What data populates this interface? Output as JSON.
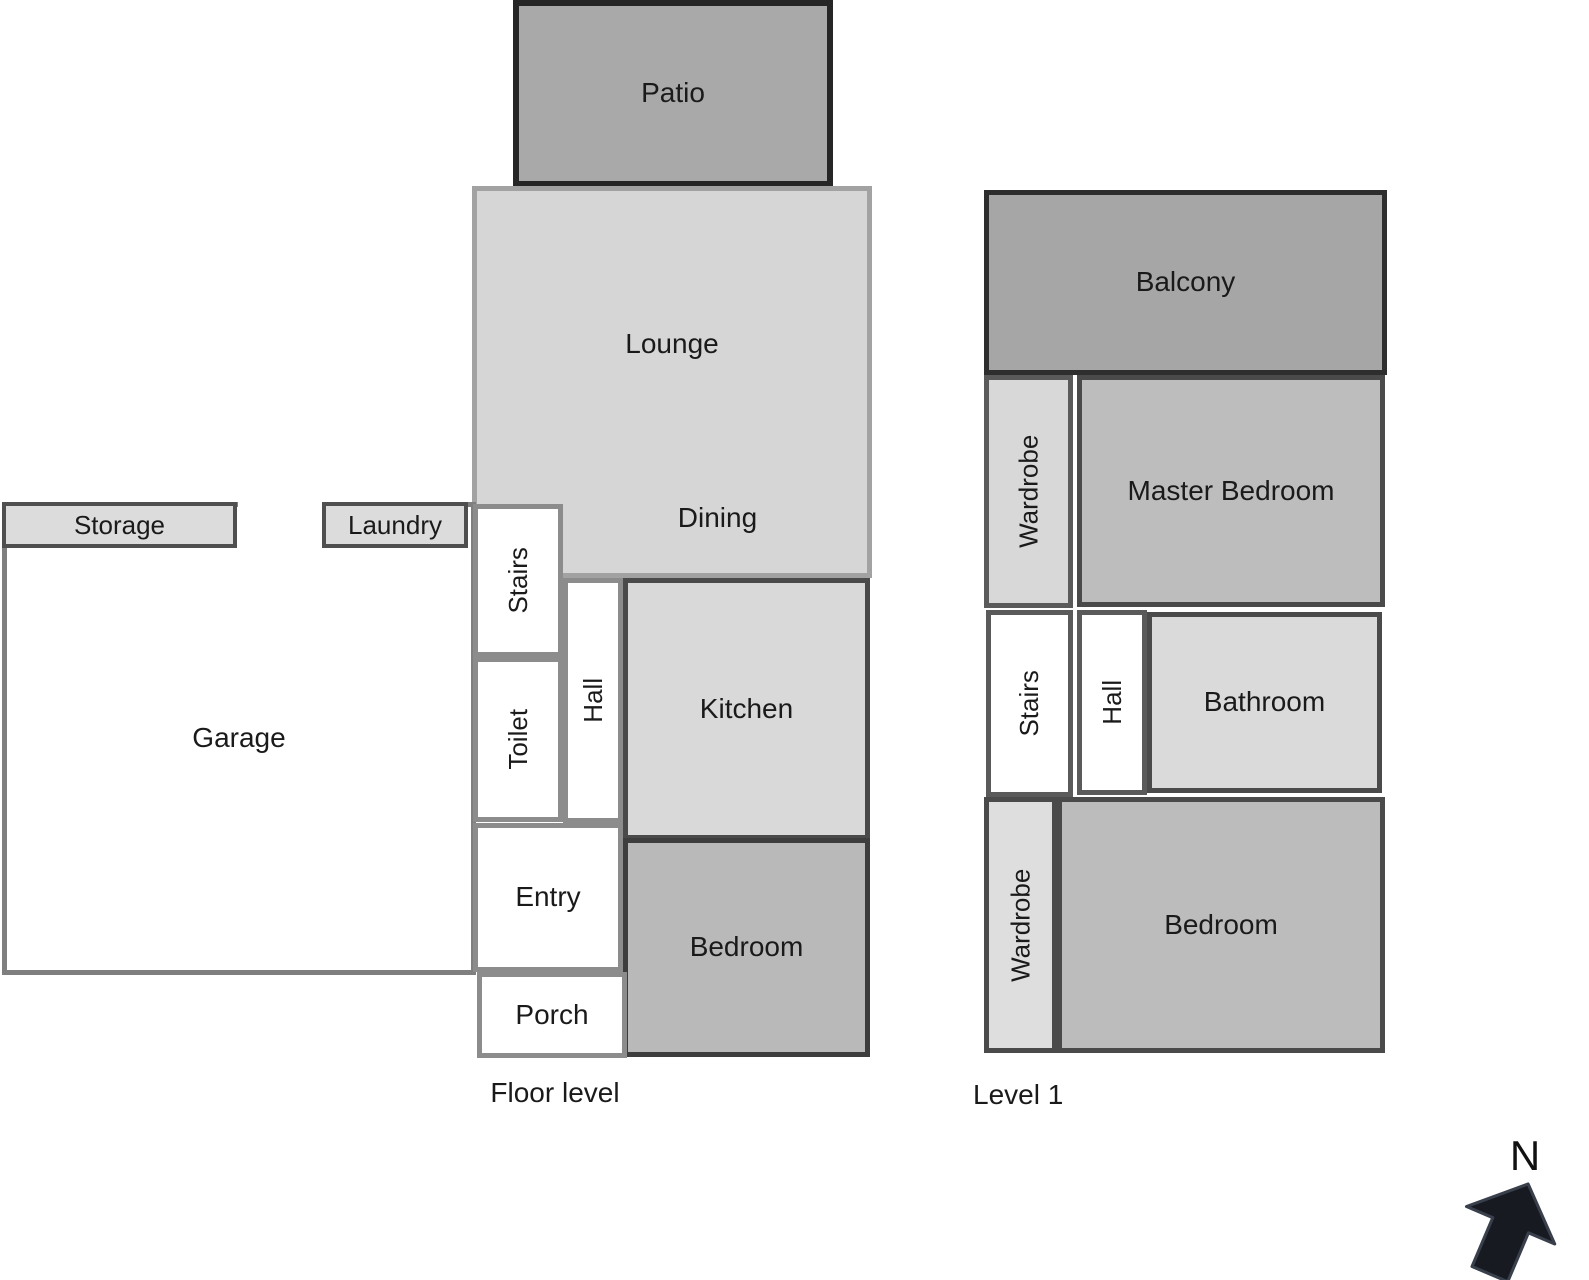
{
  "diagram": {
    "type": "floor-plan",
    "floor_level": {
      "caption": "Floor level",
      "rooms": {
        "patio": "Patio",
        "lounge": "Lounge",
        "dining": "Dining",
        "storage": "Storage",
        "laundry": "Laundry",
        "garage": "Garage",
        "stairs": "Stairs",
        "toilet": "Toilet",
        "hall": "Hall",
        "kitchen": "Kitchen",
        "entry": "Entry",
        "porch": "Porch",
        "bedroom": "Bedroom"
      }
    },
    "level_1": {
      "caption": "Level 1",
      "rooms": {
        "balcony": "Balcony",
        "wardrobe_top": "Wardrobe",
        "master_bedroom": "Master Bedroom",
        "stairs": "Stairs",
        "hall": "Hall",
        "bathroom": "Bathroom",
        "wardrobe_bottom": "Wardrobe",
        "bedroom": "Bedroom"
      }
    },
    "compass": {
      "north_label": "N"
    },
    "colors": {
      "outdoor_fill": "#a9a9a9",
      "living_fill": "#d6d6d6",
      "bedroom_fill": "#bcbcbc",
      "utility_fill": "#dcdcdc",
      "bathroom_fill": "#dadada",
      "white_room_fill": "#ffffff",
      "exterior_border": "#262626",
      "interior_dark_border": "#4a4a4a",
      "interior_light_border": "#8c8c8c",
      "arrow_fill": "#171a20",
      "text": "#1a1a1a"
    }
  }
}
